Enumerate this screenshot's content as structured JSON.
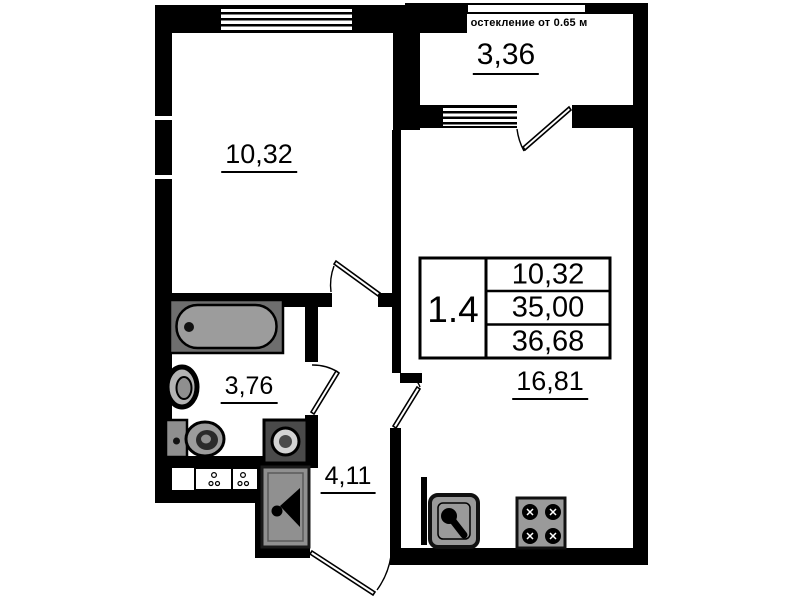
{
  "floorplan": {
    "unit": {
      "number": "1.4",
      "areas": {
        "row1": "10,32",
        "row2": "35,00",
        "row3": "36,68"
      }
    },
    "labels": {
      "room": "10,32",
      "kitchen_living": "16,81",
      "bathroom": "3,76",
      "hallway": "4,11",
      "balcony": "3,36",
      "glazing_note": "остекление от 0.65 м"
    },
    "colors": {
      "wall": "#000000",
      "fixture_light": "#9c9c9c",
      "fixture_dark": "#4a4a4a",
      "background": "#ffffff"
    },
    "fixtures": [
      "bathtub-icon",
      "sink-icon",
      "toilet-icon",
      "washing-machine-icon",
      "wardrobe-hanger-icon",
      "kitchen-sink-icon",
      "stove-icon",
      "door-swing-icon",
      "window-icon",
      "vent-shaft-icon"
    ]
  }
}
